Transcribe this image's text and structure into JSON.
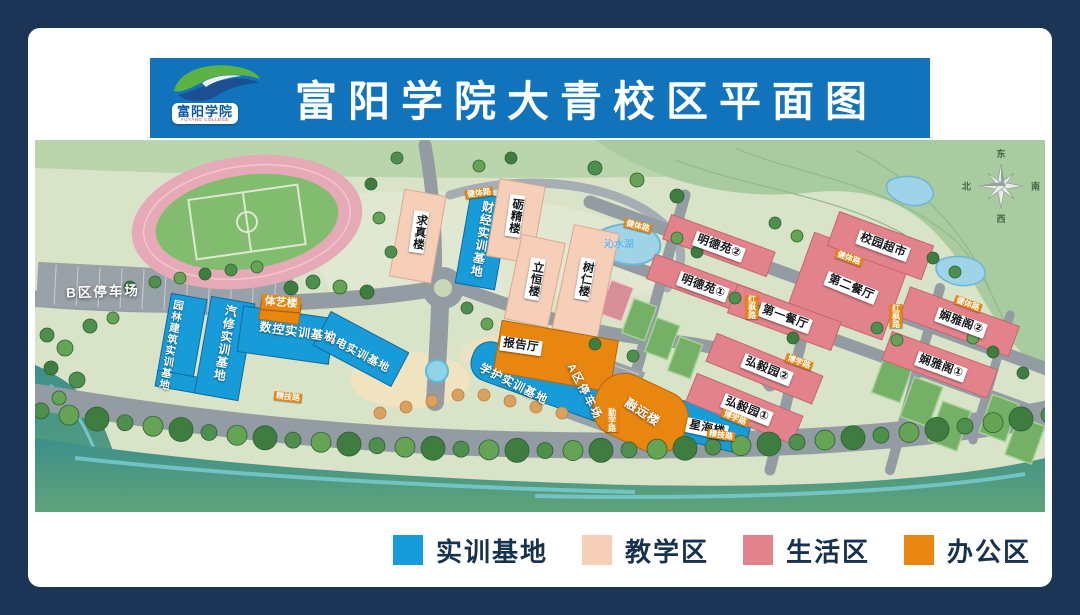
{
  "header": {
    "title": "富阳学院大青校区平面图",
    "logo": {
      "name_cn": "富阳学院",
      "name_en": "FUYANG COLLEGE"
    }
  },
  "legend": {
    "items": [
      {
        "key": "training",
        "label": "实训基地",
        "color": "#189CD9"
      },
      {
        "key": "teaching",
        "label": "教学区",
        "color": "#F5CFB8"
      },
      {
        "key": "living",
        "label": "生活区",
        "color": "#E2828A"
      },
      {
        "key": "office",
        "label": "办公区",
        "color": "#E8860F"
      }
    ]
  },
  "compass": {
    "east": "东",
    "south": "南",
    "west": "西",
    "north": "北"
  },
  "map": {
    "parking": {
      "b": "B区停车场",
      "a": "A区停车场"
    },
    "water": {
      "lake": "沁水湖"
    },
    "buildings": {
      "garden_training": "园林建筑实训基地",
      "auto_training": "汽修实训基地",
      "cnc_training": "数控实训基地",
      "mech_training": "机电实训基地",
      "finance_training": "财经实训基地",
      "nursing_training": "学护实训基地",
      "tiyi": "体艺楼",
      "qiuzhen": "求真楼",
      "lijing": "砺精楼",
      "liheng": "立恒楼",
      "shuren": "树仁楼",
      "lecture_hall": "报告厅",
      "rongyuan": "融远楼",
      "xinghai": "星海楼",
      "mingde1": "明德苑①",
      "mingde2": "明德苑②",
      "canteen1": "第一餐厅",
      "canteen2": "第二餐厅",
      "supermarket": "校园超市",
      "xianya1": "娴雅阁①",
      "xianya2": "娴雅阁②",
      "hongyi1": "弘毅园①",
      "hongyi2": "弘毅园②"
    },
    "roads": {
      "jianti": "健体路",
      "jingji": "精技路",
      "hongfeng": "红枫路",
      "qinxue": "勤学路",
      "boxue": "博学路"
    }
  }
}
